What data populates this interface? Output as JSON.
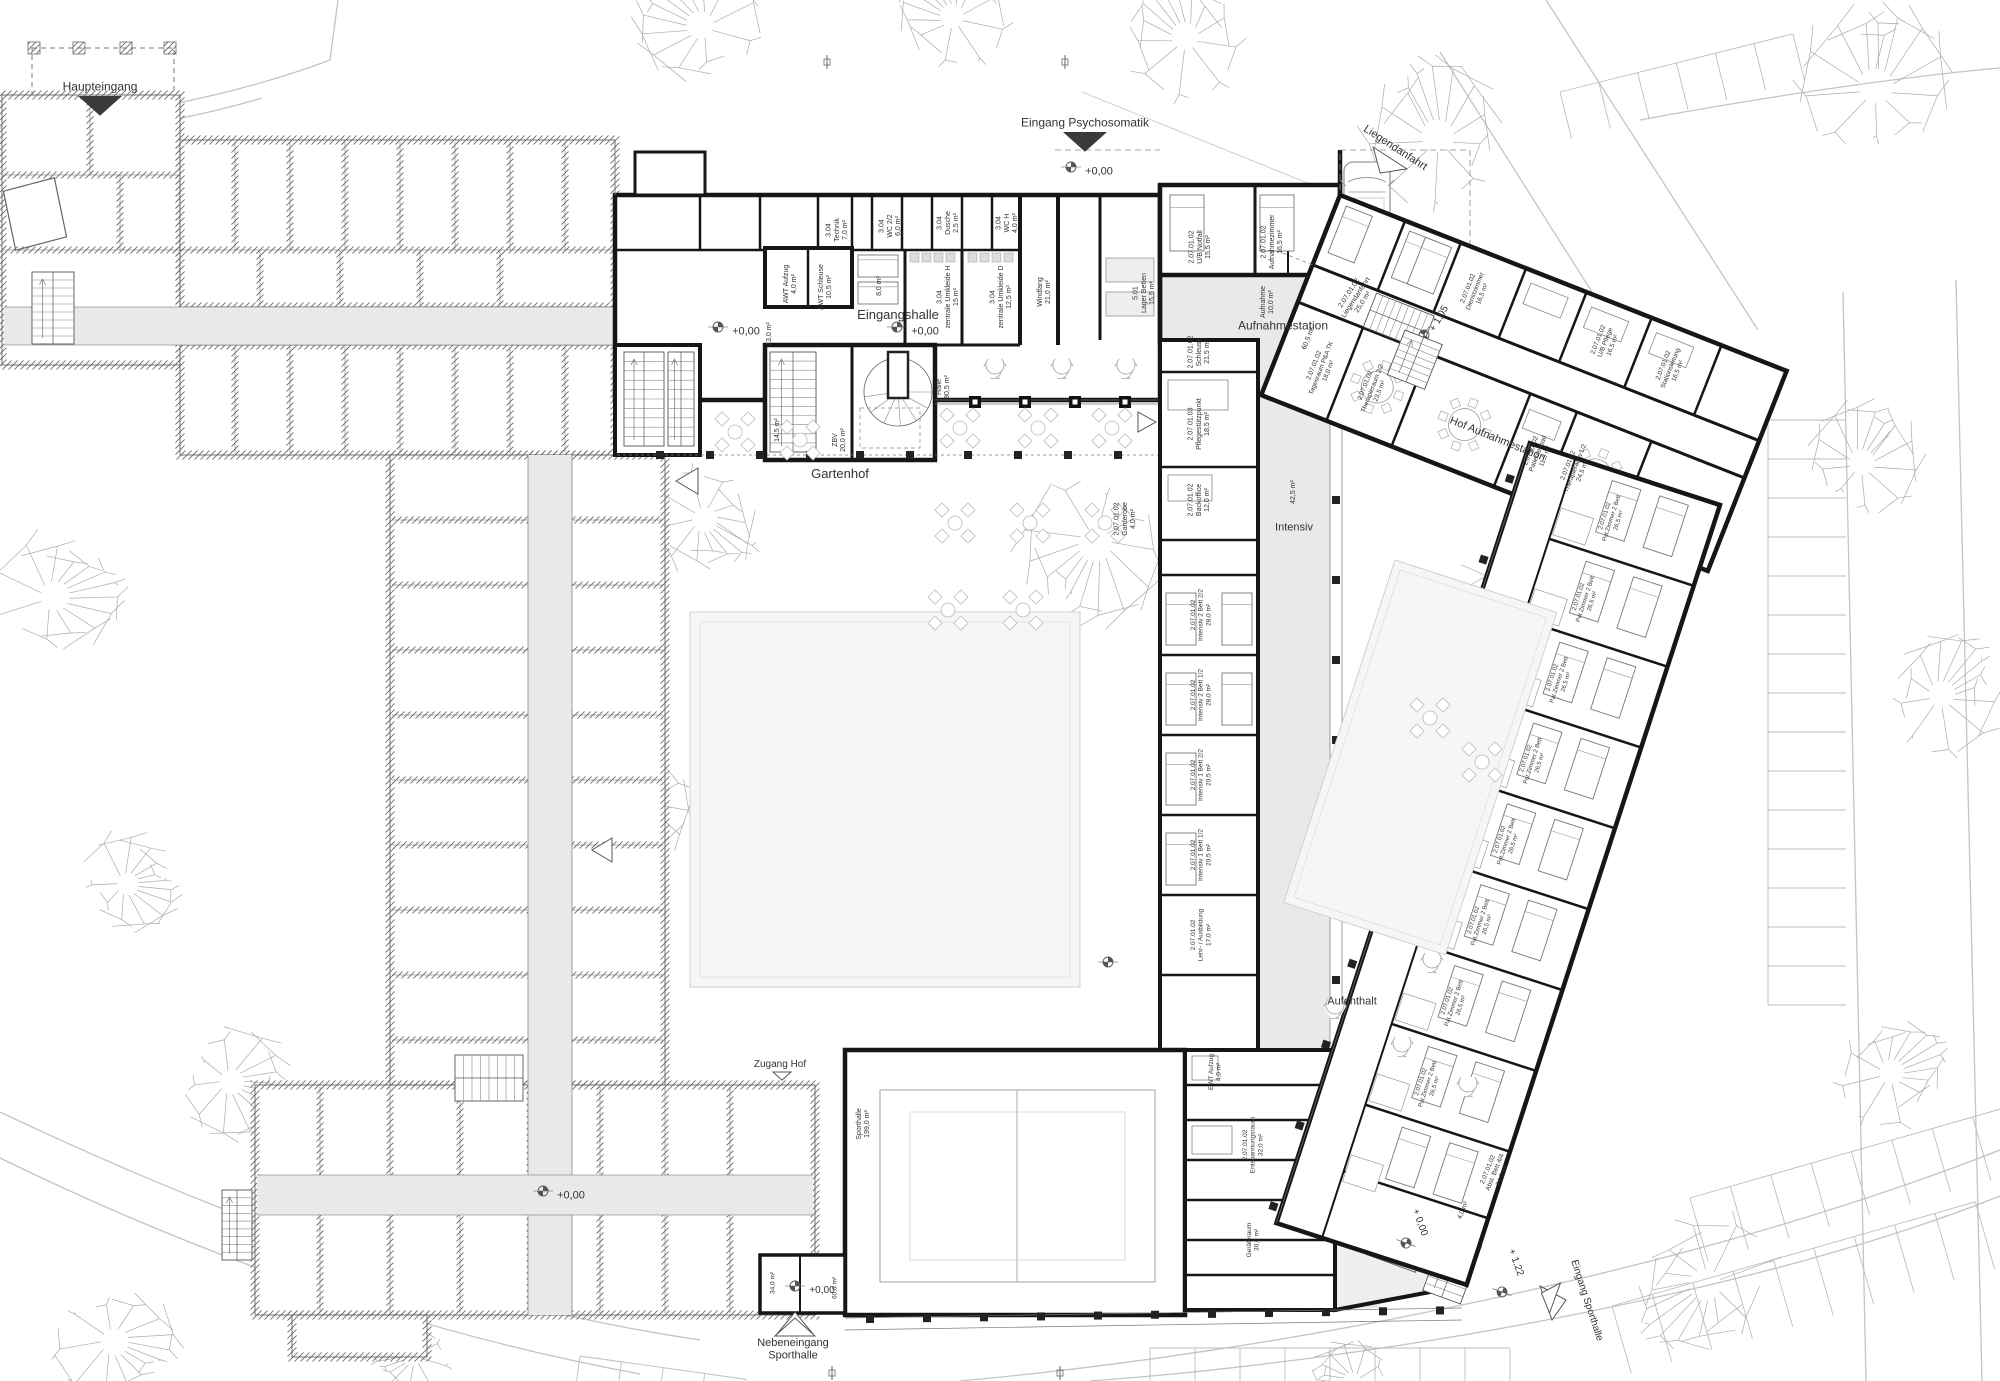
{
  "drawing": {
    "type": "architectural floor plan",
    "floor_level": "+0,00",
    "colors": {
      "wall_new": "#161616",
      "wall_old_hatch": "#6b6b6b",
      "corridor": "#e9e9e9",
      "hall_floor": "#e6e6e6",
      "lawn": "#f6f6f6",
      "tree": "#ababab",
      "road": "#c4c4c4",
      "label": "#333333"
    }
  },
  "labels": [
    {
      "id": "haupteingang",
      "lines": [
        "Haupteingang"
      ],
      "x": 100,
      "y": 86,
      "s": 12
    },
    {
      "id": "eingang-psychosomatik",
      "lines": [
        "Eingang Psychosomatik"
      ],
      "x": 1085,
      "y": 122,
      "s": 12
    },
    {
      "id": "liegendanfahrt",
      "lines": [
        "Liegendanfahrt"
      ],
      "x": 1396,
      "y": 147,
      "r": 33,
      "s": 11
    },
    {
      "id": "eingangshalle",
      "lines": [
        "Eingangshalle"
      ],
      "x": 898,
      "y": 314,
      "s": 13
    },
    {
      "id": "gartenhof",
      "lines": [
        "Gartenhof"
      ],
      "x": 840,
      "y": 473,
      "s": 13
    },
    {
      "id": "aufnahmestation",
      "lines": [
        "Aufnahmestation"
      ],
      "x": 1283,
      "y": 325,
      "s": 12
    },
    {
      "id": "hof-aufnahmestation",
      "lines": [
        "Hof Aufnahmestation"
      ],
      "x": 1498,
      "y": 438,
      "r": 22,
      "s": 11
    },
    {
      "id": "intensiv",
      "lines": [
        "Intensiv"
      ],
      "x": 1294,
      "y": 526,
      "s": 11
    },
    {
      "id": "aufenthalt",
      "lines": [
        "Aufenthalt"
      ],
      "x": 1352,
      "y": 1000,
      "s": 11
    },
    {
      "id": "zugang-hof",
      "lines": [
        "Zugang Hof"
      ],
      "x": 780,
      "y": 1063,
      "s": 10
    },
    {
      "id": "nebeneingang-sporthalle",
      "lines": [
        "Nebeneingang",
        "Sporthalle"
      ],
      "x": 793,
      "y": 1348,
      "s": 11
    },
    {
      "id": "eingang-sporthalle",
      "lines": [
        "Eingang Sporthalle"
      ],
      "x": 1588,
      "y": 1300,
      "r": 72,
      "s": 10
    },
    {
      "id": "lvl-altbau-nord",
      "lines": [
        "+0,00"
      ],
      "x": 746,
      "y": 330,
      "s": 11
    },
    {
      "id": "lvl-eingangshalle",
      "lines": [
        "+0,00"
      ],
      "x": 925,
      "y": 330,
      "s": 11
    },
    {
      "id": "lvl-psychosomatik",
      "lines": [
        "+0,00"
      ],
      "x": 1099,
      "y": 170,
      "s": 11
    },
    {
      "id": "lvl-altbau-sued",
      "lines": [
        "+0,00"
      ],
      "x": 571,
      "y": 1194,
      "s": 11
    },
    {
      "id": "lvl-sporthalle",
      "lines": [
        "+0,00"
      ],
      "x": 822,
      "y": 1289,
      "s": 10
    },
    {
      "id": "lvl-tip-000",
      "lines": [
        "+ 0,00"
      ],
      "x": 1421,
      "y": 1222,
      "r": 70,
      "s": 10
    },
    {
      "id": "lvl-tip-122",
      "lines": [
        "+ 1,22"
      ],
      "x": 1517,
      "y": 1262,
      "r": 70,
      "s": 10
    },
    {
      "id": "lvl-hof-105",
      "lines": [
        "+ 1,05"
      ],
      "x": 1438,
      "y": 318,
      "r": -60,
      "s": 10
    },
    {
      "id": "r-technik",
      "lines": [
        "3.04",
        "Technik",
        "7,0 m²"
      ],
      "x": 836,
      "y": 230,
      "r": -90,
      "s": 7
    },
    {
      "id": "r-wc22",
      "lines": [
        "3.04",
        "WC 2/2",
        "6,0 m²"
      ],
      "x": 889,
      "y": 226,
      "r": -90,
      "s": 7
    },
    {
      "id": "r-dusche",
      "lines": [
        "3.04",
        "Dusche",
        "2,5 m²"
      ],
      "x": 947,
      "y": 223,
      "r": -90,
      "s": 7
    },
    {
      "id": "r-wch",
      "lines": [
        "3.04",
        "WC H",
        "4,0 m²"
      ],
      "x": 1006,
      "y": 223,
      "r": -90,
      "s": 7
    },
    {
      "id": "r-awt-aufzug",
      "lines": [
        "AWT Aufzug",
        "4,0 m²"
      ],
      "x": 789,
      "y": 284,
      "r": -90,
      "s": 7
    },
    {
      "id": "r-awt-schleuse",
      "lines": [
        "AWT Schleuse",
        "10,5 m²"
      ],
      "x": 824,
      "y": 287,
      "r": -90,
      "s": 7
    },
    {
      "id": "r-8qm",
      "lines": [
        "8,0 m²"
      ],
      "x": 878,
      "y": 286,
      "r": -90,
      "s": 7
    },
    {
      "id": "r-umkleide-h",
      "lines": [
        "3.04",
        "zentrale Umkleide H",
        "15 m²"
      ],
      "x": 947,
      "y": 297,
      "r": -90,
      "s": 7
    },
    {
      "id": "r-umkleide-d",
      "lines": [
        "3.04",
        "zentrale Umkleide D",
        "12,5 m²"
      ],
      "x": 1000,
      "y": 297,
      "r": -90,
      "s": 7
    },
    {
      "id": "r-windfang",
      "lines": [
        "Windfang",
        "21,0 m²"
      ],
      "x": 1043,
      "y": 292,
      "r": -90,
      "s": 7
    },
    {
      "id": "r-lager-betten",
      "lines": [
        "5.01",
        "Lager Betten",
        "15,5 m²"
      ],
      "x": 1143,
      "y": 293,
      "r": -90,
      "s": 7
    },
    {
      "id": "r-13qm",
      "lines": [
        "13,0 m²"
      ],
      "x": 768,
      "y": 334,
      "r": -90,
      "s": 7
    },
    {
      "id": "r-145qm",
      "lines": [
        "14,5 m²"
      ],
      "x": 776,
      "y": 430,
      "r": -90,
      "s": 7
    },
    {
      "id": "r-zbv",
      "lines": [
        "ZBV",
        "20,0 m²"
      ],
      "x": 838,
      "y": 440,
      "r": -90,
      "s": 7
    },
    {
      "id": "r-halle",
      "lines": [
        "Halle",
        "80,5 m²"
      ],
      "x": 942,
      "y": 387,
      "r": -90,
      "s": 7
    },
    {
      "id": "r-ub-notfall",
      "lines": [
        "2.07.01.02",
        "U/B Notfall",
        "15,5 m²"
      ],
      "x": 1199,
      "y": 247,
      "r": -90,
      "s": 7
    },
    {
      "id": "r-aufnahmezimmer",
      "lines": [
        "2.07.01.02",
        "Aufnahmezimmer",
        "16,5 m²"
      ],
      "x": 1271,
      "y": 242,
      "r": -90,
      "s": 7
    },
    {
      "id": "r-aufnahme",
      "lines": [
        "Aufnahme",
        "10,0 m²"
      ],
      "x": 1266,
      "y": 302,
      "r": -90,
      "s": 7
    },
    {
      "id": "r-liegendanfahrt",
      "lines": [
        "2.07.01.02",
        "Liegendanfahrt",
        "25,0 m²"
      ],
      "x": 1355,
      "y": 297,
      "r": -57,
      "s": 7
    },
    {
      "id": "r-schleuse",
      "lines": [
        "2.07.01.02",
        "Schleuse",
        "21,5 m²"
      ],
      "x": 1198,
      "y": 352,
      "r": -90,
      "s": 7
    },
    {
      "id": "r-pflegestuetzpunkt",
      "lines": [
        "2.07.01.03",
        "Pflegestützpunkt",
        "18,5 m²"
      ],
      "x": 1198,
      "y": 424,
      "r": -90,
      "s": 7
    },
    {
      "id": "r-backoffice",
      "lines": [
        "2.07.01.02",
        "Backoffice",
        "12,0 m²"
      ],
      "x": 1198,
      "y": 500,
      "r": -90,
      "s": 7
    },
    {
      "id": "r-garderobe",
      "lines": [
        "2.07.01.02",
        "Garderobe",
        "4,0 m²"
      ],
      "x": 1124,
      "y": 519,
      "r": -90,
      "s": 7
    },
    {
      "id": "r-425qm",
      "lines": [
        "42,5 m²"
      ],
      "x": 1292,
      "y": 492,
      "r": -90,
      "s": 7
    },
    {
      "id": "r-intensiv-22",
      "lines": [
        "2.07.01.02",
        "Intensiv 2 Bett 2/2",
        "28,0 m²"
      ],
      "x": 1200,
      "y": 615,
      "r": -90,
      "s": 6.5
    },
    {
      "id": "r-intensiv-21",
      "lines": [
        "2.07.01.02",
        "Intensiv 2 Bett 1/2",
        "28,0 m²"
      ],
      "x": 1200,
      "y": 695,
      "r": -90,
      "s": 6.5
    },
    {
      "id": "r-intensiv-12",
      "lines": [
        "2.07.01.02",
        "Intensiv 1 Bett 2/2",
        "20,5 m²"
      ],
      "x": 1200,
      "y": 775,
      "r": -90,
      "s": 6.5
    },
    {
      "id": "r-intensiv-11",
      "lines": [
        "2.07.01.02",
        "Intensiv 1 Bett 1/2",
        "20,5 m²"
      ],
      "x": 1200,
      "y": 855,
      "r": -90,
      "s": 6.5
    },
    {
      "id": "r-lehr-ausbildung",
      "lines": [
        "2.07.01.02",
        "Lehr- / Ausbildung",
        "17,0 m²"
      ],
      "x": 1200,
      "y": 935,
      "r": -90,
      "s": 6.5
    },
    {
      "id": "r-ewt-aufzug",
      "lines": [
        "EWT Aufzug",
        "4,0 m²"
      ],
      "x": 1214,
      "y": 1072,
      "r": -90,
      "s": 6.5
    },
    {
      "id": "r-entspannungsraum",
      "lines": [
        "2.07.01.02",
        "Entspannungsraum",
        "32,0 m²"
      ],
      "x": 1252,
      "y": 1145,
      "r": -90,
      "s": 6.5
    },
    {
      "id": "r-geraeteraum",
      "lines": [
        "Geräteraum",
        "30,0 m²"
      ],
      "x": 1252,
      "y": 1240,
      "r": -90,
      "s": 6.5
    },
    {
      "id": "r-abst-bett",
      "lines": [
        "2.07.01.02",
        "Abst. Bett 4/4",
        "24,0 m²"
      ],
      "x": 1494,
      "y": 1172,
      "r": -68,
      "s": 6.5
    },
    {
      "id": "r-4qm",
      "lines": [
        "4,0 m²"
      ],
      "x": 1462,
      "y": 1210,
      "r": -68,
      "s": 6.5
    },
    {
      "id": "r-sporthalle",
      "lines": [
        "Sporthalle",
        "199,0 m²"
      ],
      "x": 862,
      "y": 1124,
      "r": -90,
      "s": 7
    },
    {
      "id": "r-34qm",
      "lines": [
        "34,0 m²"
      ],
      "x": 772,
      "y": 1283,
      "r": -90,
      "s": 6.5
    },
    {
      "id": "r-60qm",
      "lines": [
        "60,0 m²"
      ],
      "x": 834,
      "y": 1288,
      "r": -90,
      "s": 6.5
    },
    {
      "id": "a-605qm",
      "lines": [
        "60,5 m²"
      ],
      "g": "armA",
      "x": 22,
      "y": 145,
      "r": -90,
      "s": 7
    },
    {
      "id": "a-tagesraum",
      "lines": [
        "2.07.01.02",
        "Tagesraum P&A TK",
        "18,0 m²"
      ],
      "g": "armA",
      "x": 45,
      "y": 168,
      "r": -90,
      "s": 6.5
    },
    {
      "id": "a-therapieraum-22",
      "lines": [
        "2.07.01.02",
        "Therapieraum 2/2",
        "23,5 m²"
      ],
      "g": "armA",
      "x": 100,
      "y": 168,
      "r": -90,
      "s": 6.5
    },
    {
      "id": "a-patientenbad",
      "lines": [
        "2.07.01.02",
        "Patientenbad",
        "11,5 m²"
      ],
      "g": "armA",
      "x": 278,
      "y": 168,
      "r": -90,
      "s": 6.5
    },
    {
      "id": "a-therapieraum-12",
      "lines": [
        "2.07.01.02",
        "Therapieraum 1/2",
        "24,5 m²"
      ],
      "g": "armA",
      "x": 318,
      "y": 168,
      "r": -90,
      "s": 6.5
    },
    {
      "id": "a-dienstzimmer",
      "lines": [
        "2.07.01.02",
        "Dienstzimmer",
        "16,5 m²"
      ],
      "g": "armA",
      "x": 160,
      "y": 40,
      "r": -90,
      "s": 6.5
    },
    {
      "id": "a-ub-pflege",
      "lines": [
        "2.07.01.02",
        "U/B Pflege",
        "16,5 m²"
      ],
      "g": "armA",
      "x": 300,
      "y": 40,
      "r": -90,
      "s": 6.5
    },
    {
      "id": "a-stationsleitung",
      "lines": [
        "2.07.01.02",
        "Stationsleitung",
        "16,5 m²"
      ],
      "g": "armA",
      "x": 370,
      "y": 40,
      "r": -90,
      "s": 6.5
    },
    {
      "id": "b-zimmer-1",
      "lines": [
        "2.07.01.02",
        "Pat.Zimmer 2 Bett",
        "26,5 m²"
      ],
      "g": "armB",
      "x": -100,
      "y": 46,
      "r": -90,
      "s": 6
    },
    {
      "id": "b-zimmer-2",
      "lines": [
        "2.07.01.02",
        "Pat.Zimmer 2 Bett",
        "26,5 m²"
      ],
      "g": "armB",
      "x": -100,
      "y": 131,
      "r": -90,
      "s": 6
    },
    {
      "id": "b-zimmer-3",
      "lines": [
        "2.07.01.02",
        "Pat.Zimmer 2 Bett",
        "26,5 m²"
      ],
      "g": "armB",
      "x": -100,
      "y": 216,
      "r": -90,
      "s": 6
    },
    {
      "id": "b-zimmer-4",
      "lines": [
        "2.07.01.02",
        "Pat.Zimmer 2 Bett",
        "26,5 m²"
      ],
      "g": "armB",
      "x": -100,
      "y": 301,
      "r": -90,
      "s": 6
    },
    {
      "id": "b-zimmer-5",
      "lines": [
        "2.07.01.02",
        "Pat.Zimmer 2 Bett",
        "26,5 m²"
      ],
      "g": "armB",
      "x": -100,
      "y": 386,
      "r": -90,
      "s": 6
    },
    {
      "id": "b-zimmer-6",
      "lines": [
        "2.07.01.02",
        "Pat.Zimmer 2 Bett",
        "26,5 m²"
      ],
      "g": "armB",
      "x": -100,
      "y": 471,
      "r": -90,
      "s": 6
    },
    {
      "id": "b-zimmer-7",
      "lines": [
        "2.07.01.02",
        "Pat.Zimmer 2 Bett",
        "26,5 m²"
      ],
      "g": "armB",
      "x": -100,
      "y": 556,
      "r": -90,
      "s": 6
    },
    {
      "id": "b-zimmer-8",
      "lines": [
        "2.07.01.02",
        "Pat.Zimmer 2 Bett",
        "26,5 m²"
      ],
      "g": "armB",
      "x": -100,
      "y": 641,
      "r": -90,
      "s": 6
    }
  ]
}
